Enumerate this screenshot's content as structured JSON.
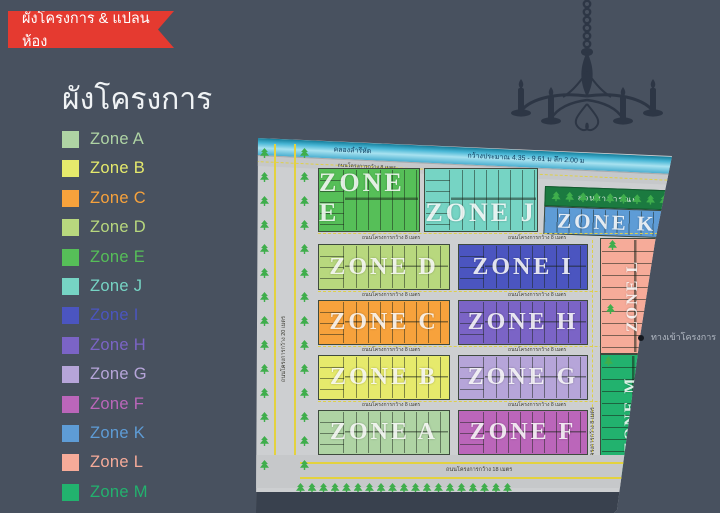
{
  "ribbon": {
    "label": "ผังโครงการ & แปลนห้อง",
    "color": "#e53a30"
  },
  "title": "ผังโครงการ",
  "zones": [
    {
      "id": "A",
      "name": "Zone A",
      "map_label": "ZONE A",
      "color": "#afd4a4"
    },
    {
      "id": "B",
      "name": "Zone B",
      "map_label": "ZONE B",
      "color": "#e6ea6c"
    },
    {
      "id": "C",
      "name": "Zone C",
      "map_label": "ZONE C",
      "color": "#f7a23c"
    },
    {
      "id": "D",
      "name": "Zone D",
      "map_label": "ZONE D",
      "color": "#b8d87e"
    },
    {
      "id": "E",
      "name": "Zone E",
      "map_label": "ZONE E",
      "color": "#56bf58"
    },
    {
      "id": "J",
      "name": "Zone J",
      "map_label": "ZONE J",
      "color": "#76d4c4"
    },
    {
      "id": "I",
      "name": "Zone I",
      "map_label": "ZONE I",
      "color": "#4b55c0"
    },
    {
      "id": "H",
      "name": "Zone H",
      "map_label": "ZONE H",
      "color": "#7b64c6"
    },
    {
      "id": "G",
      "name": "Zone G",
      "map_label": "ZONE G",
      "color": "#b6a5d9"
    },
    {
      "id": "F",
      "name": "Zone F",
      "map_label": "ZONE F",
      "color": "#bb66ba"
    },
    {
      "id": "K",
      "name": "Zone K",
      "map_label": "ZONE K",
      "color": "#5e9cd6"
    },
    {
      "id": "L",
      "name": "Zone L",
      "map_label": "ZONE L",
      "color": "#f6ab99"
    },
    {
      "id": "M",
      "name": "Zone M",
      "map_label": "ZONE M",
      "color": "#22b26e"
    }
  ],
  "map": {
    "canal_name": "คลองลำรีหัด",
    "canal_dimension": "กว้างประมาณ 4.35 - 9.61 ม ลึก 2.00 ม",
    "park_label": "สวนสาธารณะ",
    "road_8m": "ถนนโครงการกว้าง 8 เมตร",
    "road_18m": "ถนนโครงการกว้าง 18 เมตร",
    "road_20m": "ถนนโครงการกว้าง 20 เมตร",
    "entrance_label": "ทางเข้าโครงการ"
  }
}
